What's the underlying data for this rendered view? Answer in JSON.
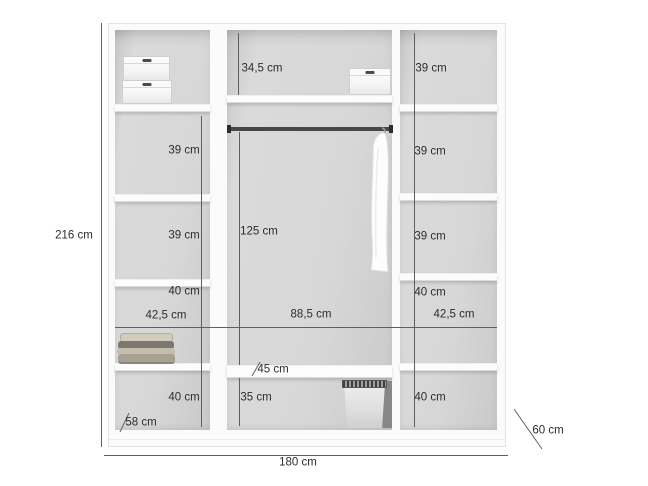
{
  "diagram": {
    "type": "wardrobe-interior-dimension-diagram",
    "colors": {
      "background": "#ffffff",
      "carcass": "#fbfbfb",
      "back_panel": "#d4d4d4",
      "rod": "#474747",
      "dimension_line": "#5f5f5f",
      "text": "#2d2d2d"
    },
    "outer": {
      "height": "216 cm",
      "width": "180 cm",
      "depth": "60 cm"
    },
    "left_column": {
      "shelf2_height": "39 cm",
      "shelf3_height": "39 cm",
      "shelf4_height": "40 cm",
      "shelf5_height": "40 cm",
      "width": "42,5 cm",
      "interior_depth": "58 cm"
    },
    "middle_column": {
      "top_height": "34,5 cm",
      "hanging_height": "125 cm",
      "width": "88,5 cm",
      "shelf_depth": "45 cm",
      "bottom_height": "35 cm"
    },
    "right_column": {
      "shelf1_height": "39 cm",
      "shelf2_height": "39 cm",
      "shelf3_height": "39 cm",
      "shelf4_height": "40 cm",
      "shelf5_height": "40 cm",
      "width": "42,5 cm"
    },
    "objects": {
      "left_top": "stacked-storage-boxes",
      "middle_top": "storage-box",
      "middle_rail": "clothes-rail",
      "middle_hanging": "hanging-garment",
      "left_shelf": "folded-clothes",
      "middle_bottom": "laundry-basket"
    }
  }
}
